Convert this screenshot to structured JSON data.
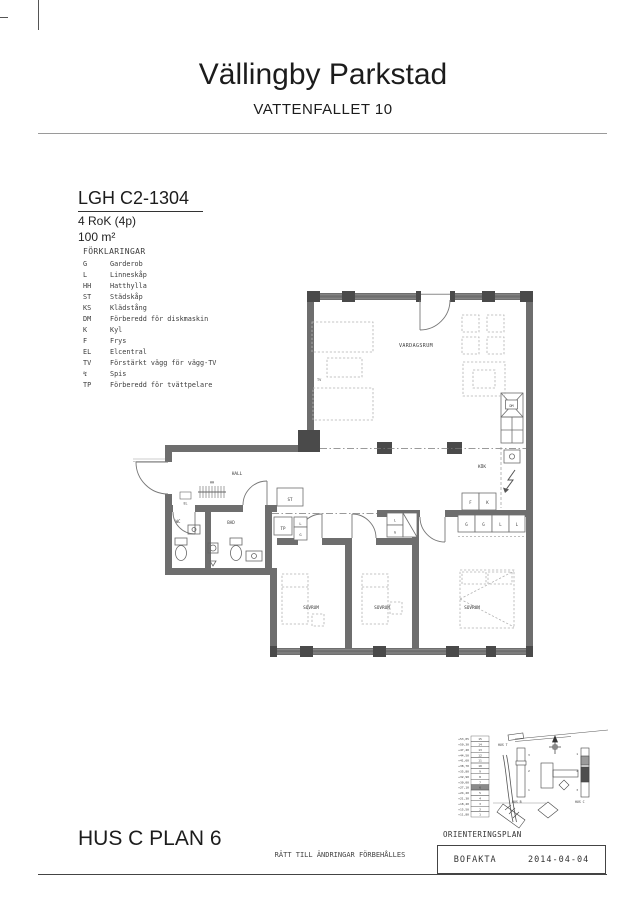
{
  "header": {
    "title": "Vällingby Parkstad",
    "subtitle": "VATTENFALLET 10"
  },
  "apartment": {
    "id": "LGH C2-1304",
    "rooms": "4 RoK (4p)",
    "area": "100 m²"
  },
  "legend": {
    "heading": "FÖRKLARINGAR",
    "items": [
      {
        "key": "G",
        "label": "Garderob"
      },
      {
        "key": "L",
        "label": "Linneskåp"
      },
      {
        "key": "HH",
        "label": "Hatthylla"
      },
      {
        "key": "ST",
        "label": "Städskåp"
      },
      {
        "key": "KS",
        "label": "Klädstång"
      },
      {
        "key": "DM",
        "label": "Förberedd för diskmaskin"
      },
      {
        "key": "K",
        "label": "Kyl"
      },
      {
        "key": "F",
        "label": "Frys"
      },
      {
        "key": "EL",
        "label": "Elcentral"
      },
      {
        "key": "TV",
        "label": "Förstärkt vägg för vägg-TV"
      },
      {
        "key": "↯",
        "label": "Spis"
      },
      {
        "key": "TP",
        "label": "Förberedd för tvättpelare"
      }
    ]
  },
  "plan": {
    "rooms": {
      "livingroom": "VARDAGSRUM",
      "kitchen": "KÖK",
      "hall": "HALL",
      "bath": "BAD",
      "wc": "WC",
      "bedroom": "SOVRUM"
    },
    "labels": {
      "st": "ST",
      "tp": "TP",
      "l": "L",
      "g": "G",
      "f": "F",
      "k": "K",
      "dm": "DM",
      "hh": "HH",
      "el": "EL",
      "tv": "TV"
    }
  },
  "orientation": {
    "heading": "ORIENTERINGSPLAN",
    "highlight_floor": "6",
    "levels": [
      {
        "elev": "+53,05",
        "floor": "15"
      },
      {
        "elev": "+50,30",
        "floor": "14"
      },
      {
        "elev": "+47,40",
        "floor": "13"
      },
      {
        "elev": "+44,50",
        "floor": "12"
      },
      {
        "elev": "+41,60",
        "floor": "11"
      },
      {
        "elev": "+38,70",
        "floor": "10"
      },
      {
        "elev": "+35,80",
        "floor": "9"
      },
      {
        "elev": "+32,90",
        "floor": "8"
      },
      {
        "elev": "+30,00",
        "floor": "7"
      },
      {
        "elev": "+27,10",
        "floor": "6"
      },
      {
        "elev": "+24,20",
        "floor": "5"
      },
      {
        "elev": "+21,30",
        "floor": "4"
      },
      {
        "elev": "+18,40",
        "floor": "3"
      },
      {
        "elev": "+15,50",
        "floor": "2"
      },
      {
        "elev": "+11,80",
        "floor": "1"
      }
    ],
    "hus_t": "HUS T",
    "hus_b": "HUS B",
    "hus_c": "HUS C",
    "hus_b_floors": [
      "3",
      "2",
      "1"
    ],
    "hus_c_floors": [
      "1",
      "2",
      "3"
    ]
  },
  "footer": {
    "plan_title": "HUS C PLAN 6",
    "disclaimer": "RÄTT TILL ÄNDRINGAR FÖRBEHÅLLES",
    "brand": "BOFAKTA",
    "date": "2014-04-04"
  }
}
